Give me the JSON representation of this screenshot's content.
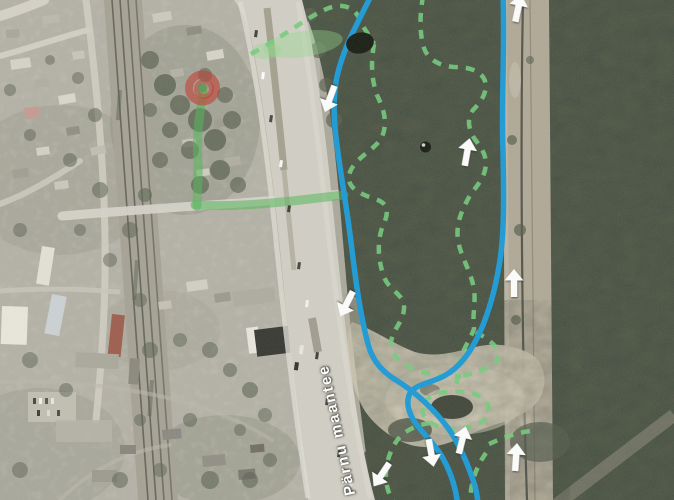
{
  "road_label": "Pärnu maantee",
  "overlay": {
    "colors": {
      "trail_blue": "#1899d6",
      "trail_green": "#72cc7b",
      "route_green": "#4fb654",
      "marker_red": "#c2392f",
      "arrow": "#ffffff",
      "pond": "#141a10",
      "patch_green": "#8fd98a"
    },
    "start_marker": {
      "x": 202.5,
      "y": 88
    },
    "highlight_areas": [
      {
        "cx": 303,
        "cy": 44,
        "rx": 40,
        "ry": 13,
        "rot": -8
      },
      {
        "cx": 266,
        "cy": 51,
        "rx": 15,
        "ry": 8,
        "rot": -5
      }
    ],
    "dots": [
      {
        "cx": 360,
        "cy": 43,
        "rx": 14,
        "ry": 10.5,
        "rot": -12,
        "highlight": false
      },
      {
        "cx": 425.5,
        "cy": 147,
        "rx": 5.5,
        "ry": 5.5,
        "rot": 0,
        "highlight": true
      }
    ],
    "routes": {
      "blue": [
        "M 372 -6 C 358 22 341 52 336 82 C 332 108 335 132 339 160 C 343 188 347 210 351 242 C 355 274 359 310 368 344 C 373 363 384 373 399 382 C 415 392 434 409 448 428 C 459 443 469 467 475 486 C 477 494 478 500 478 507",
        "M 503 -6 C 505 50 501 105 503 152 C 504 200 504 234 500 260 C 496 286 489 312 480 332 C 471 352 459 368 444 376 C 431 383 416 384 410 393 C 406 401 408 411 414 421 C 422 433 433 442 441 455 C 450 470 456 487 458 507"
      ],
      "green_solid": [
        "M 203 92 C 199 118 196 140 198 162 C 199 180 197 190 197 206",
        "M 195 205 C 230 207 262 204 292 201 C 309 199 326 197 344 195"
      ],
      "green_dashed": [
        "M 251 54 C 272 43 293 28 311 17 C 323 10 333 5 342 6 C 353 7 358 14 362 24 C 366 32 370 36 374 44",
        "M 374 44 C 371 62 371 78 377 95 C 384 110 388 122 382 137 C 375 150 356 157 350 172 C 345 186 357 193 375 199 C 391 204 388 215 382 228 C 377 243 378 260 384 277 C 390 292 405 294 404 309 C 403 322 393 329 391 342 C 391 355 400 363 413 369 C 429 375 448 377 461 376",
        "M 423 -4 C 420 14 419 32 424 48 C 428 60 440 66 454 67 C 468 67 481 70 485 81 C 488 92 481 102 473 110 C 467 118 468 128 474 138 C 482 149 488 156 485 170 C 482 183 472 190 467 201 C 460 214 456 226 458 240 C 461 258 471 271 474 289 C 476 303 472 316 474 329 C 469 342 461 352 459 364 C 458 372 457 381 456 389",
        "M 476 332 C 484 337 493 342 497 349 C 501 356 497 363 489 367 C 481 371 471 374 462 376",
        "M 423 408 C 421 417 430 425 444 428 C 458 431 475 428 484 420 C 492 413 490 402 479 396 C 468 390 446 390 434 395 C 427 398 424 402 423 408 Z",
        "M 430 423 C 416 425 403 431 396 442 C 389 453 385 466 386 479 C 387 491 391 499 397 507",
        "M 489 444 C 502 438 516 433 530 431",
        "M 486 453 C 478 464 473 477 471 490 C 470 497 470 502 472 508"
      ]
    },
    "arrows": [
      {
        "x": 330,
        "y": 98,
        "rot": 200
      },
      {
        "x": 347,
        "y": 303,
        "rot": 207
      },
      {
        "x": 467,
        "y": 153,
        "rot": 10
      },
      {
        "x": 514,
        "y": 284,
        "rot": 0
      },
      {
        "x": 518,
        "y": 9,
        "rot": 12
      },
      {
        "x": 382,
        "y": 474,
        "rot": 214
      },
      {
        "x": 431,
        "y": 452,
        "rot": 170
      },
      {
        "x": 462,
        "y": 441,
        "rot": 14
      },
      {
        "x": 516,
        "y": 458,
        "rot": 4
      }
    ]
  }
}
